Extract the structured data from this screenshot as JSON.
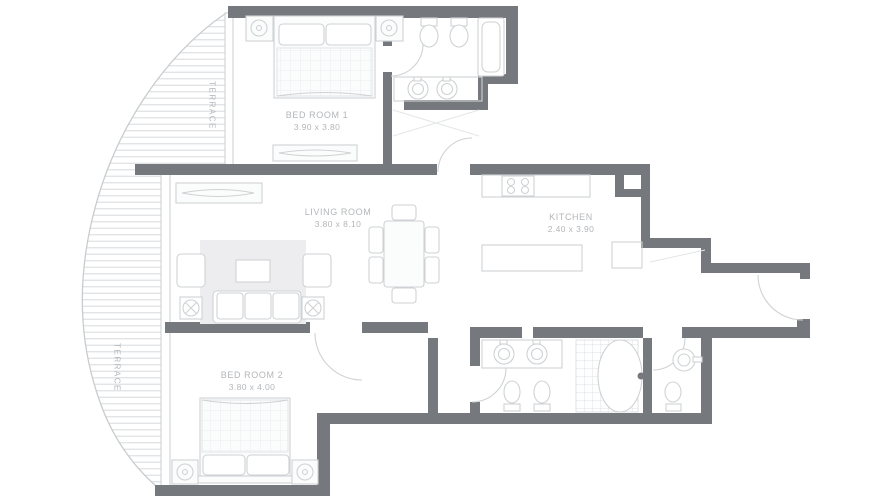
{
  "plan_title": "Apartment Floor Plan",
  "rooms": {
    "bedroom1": {
      "name": "BED ROOM 1",
      "dims": "3.90 x 3.80"
    },
    "living": {
      "name": "LIVING ROOM",
      "dims": "3.80 x 8.10"
    },
    "kitchen": {
      "name": "KITCHEN",
      "dims": "2.40 x 3.90"
    },
    "bedroom2": {
      "name": "BED ROOM 2",
      "dims": "3.80 x 4.00"
    },
    "terrace_upper": {
      "name": "TERRACE"
    },
    "terrace_lower": {
      "name": "TERRACE"
    }
  },
  "colors": {
    "wall": "#75797e",
    "line": "#cfd2d4",
    "hatch": "#dde0e2",
    "label": "#b3b6b9",
    "bg": "#ffffff",
    "fill": "#fbfcfc",
    "rug": "#ededef"
  }
}
